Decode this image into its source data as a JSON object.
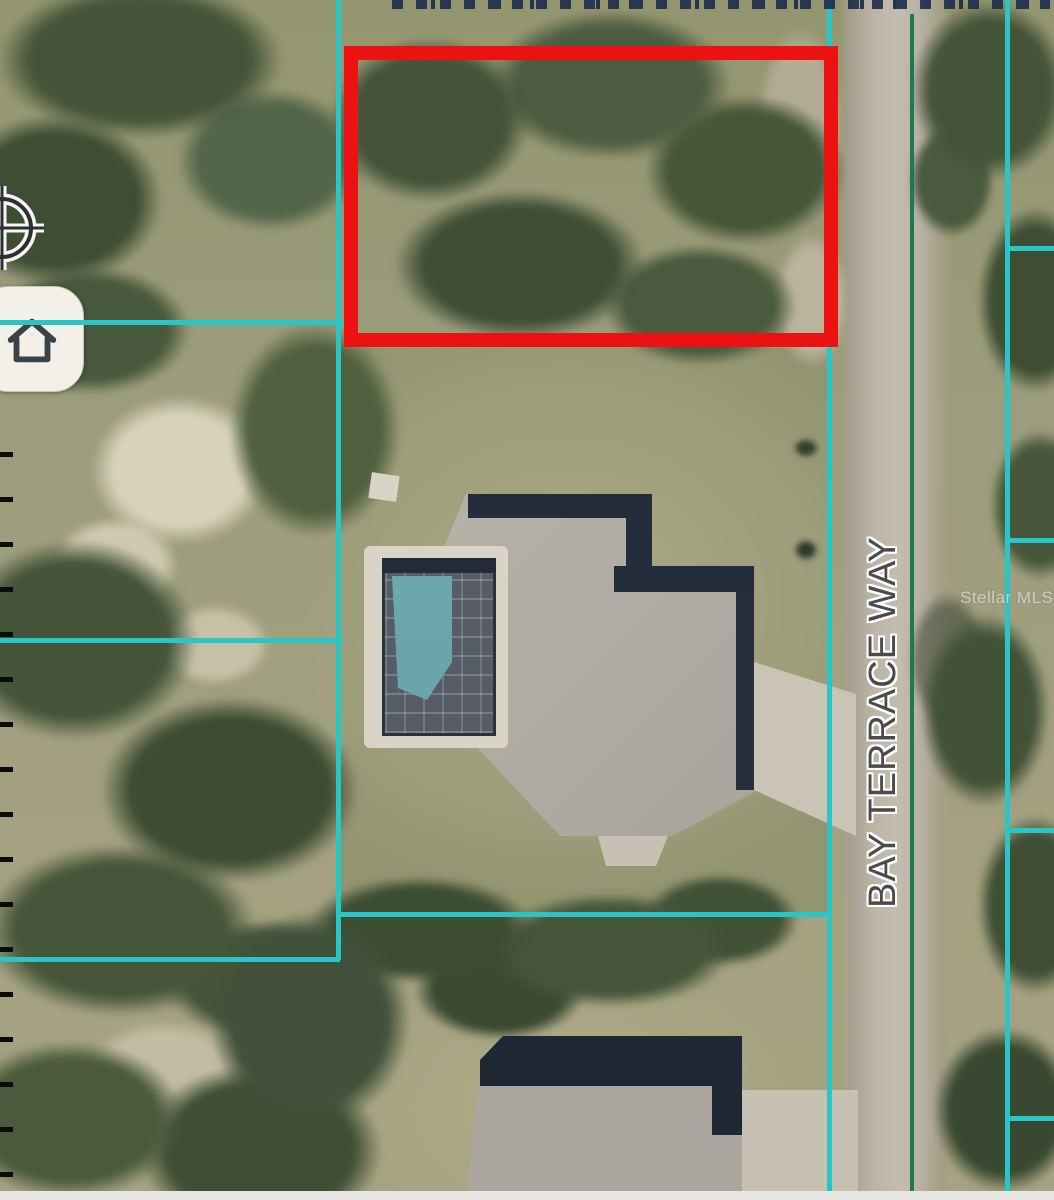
{
  "street": {
    "label": "BAY TERRACE WAY"
  },
  "watermark": {
    "label": "Stellar MLS"
  },
  "highlight": {
    "color": "#ED1212"
  },
  "lines": {
    "parcel_color": "#27C6C7",
    "road_centerline_color": "#1D7A52"
  },
  "icons": {
    "locate": "crosshair-icon",
    "home": "home-icon"
  }
}
